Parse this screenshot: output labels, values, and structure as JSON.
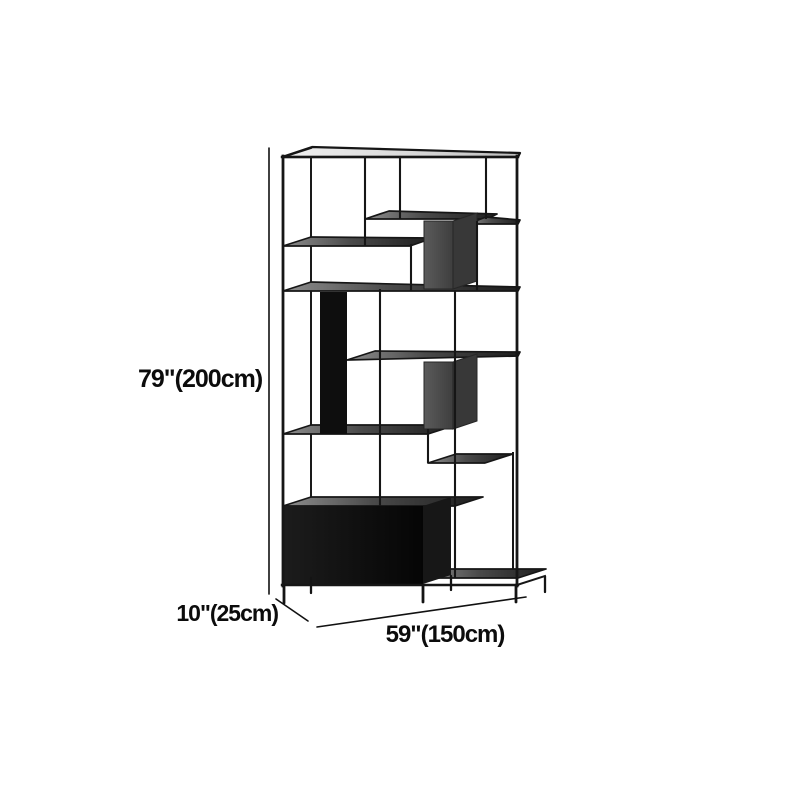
{
  "image": {
    "background_color": "#ffffff",
    "frame_color": "#161616",
    "subject": "black metal grid etagere bookshelf with staggered shelves, two gray cube compartments and a black cabinet base"
  },
  "dimensions": {
    "height": {
      "label": "79\"(200cm)"
    },
    "depth": {
      "label": "10\"(25cm)"
    },
    "width": {
      "label": "59\"(150cm)"
    }
  }
}
